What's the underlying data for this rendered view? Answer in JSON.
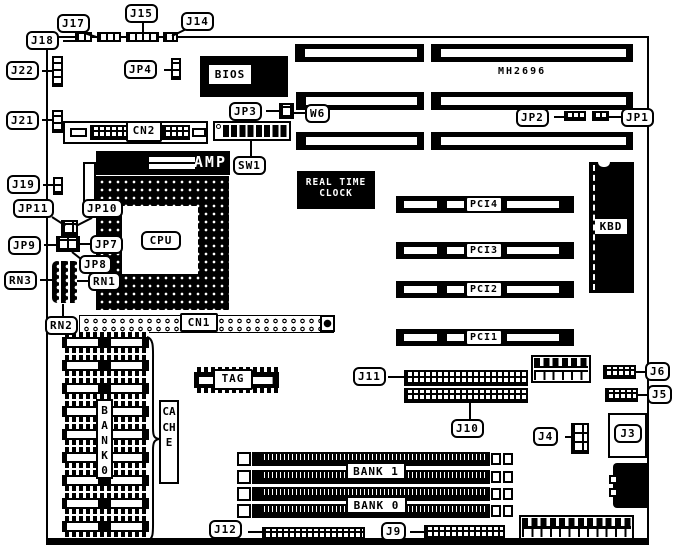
{
  "diagram": {
    "model": "MH2696",
    "chips": {
      "bios": "BIOS",
      "amp": "AMP",
      "cpu": "CPU",
      "rtc": [
        "REAL TIME",
        "CLOCK"
      ],
      "kbd": "KBD",
      "tag": "TAG",
      "bank0_stack": "BANK0",
      "cache": "CACHE"
    },
    "connectors": {
      "cn2": "CN2",
      "cn1": "CN1"
    },
    "memory": {
      "bank1": "BANK 1",
      "bank0": "BANK 0"
    },
    "pci_slots": [
      "PCI4",
      "PCI3",
      "PCI2",
      "PCI1"
    ],
    "callouts": {
      "j17": "J17",
      "j18": "J18",
      "j15": "J15",
      "j14": "J14",
      "jp4": "JP4",
      "j22": "J22",
      "j21": "J21",
      "jp3": "JP3",
      "w6": "W6",
      "sw1": "SW1",
      "jp2": "JP2",
      "jp1": "JP1",
      "j19": "J19",
      "jp11": "JP11",
      "jp10": "JP10",
      "jp9": "JP9",
      "jp7": "JP7",
      "jp8": "JP8",
      "rn3": "RN3",
      "rn1": "RN1",
      "rn2": "RN2",
      "j11": "J11",
      "j10": "J10",
      "j6": "J6",
      "j5": "J5",
      "j4": "J4",
      "j3": "J3",
      "j12": "J12",
      "j9": "J9"
    }
  }
}
